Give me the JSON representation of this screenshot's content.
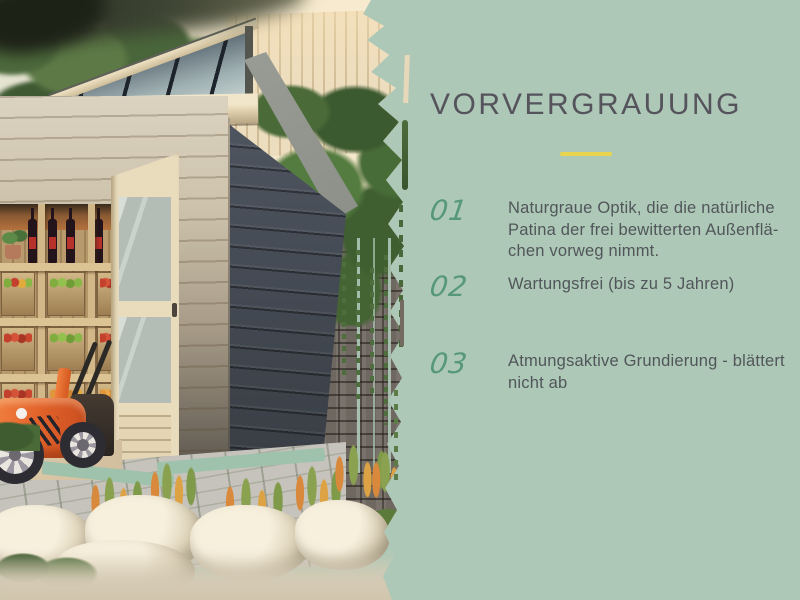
{
  "slide": {
    "background_color": "#adc8b7",
    "title": "VORVERGRAUUNG",
    "title_color": "#55535b",
    "divider_color": "#e8d54e",
    "list": {
      "number_color": "#569879",
      "text_color": "#51565a",
      "items": [
        {
          "number": "01",
          "lines": [
            "Naturgraue Optik, die die natürliche",
            "Patina der frei bewitterten Außenflä-",
            "chen vorweg nimmt."
          ]
        },
        {
          "number": "02",
          "lines": [
            "Wartungsfrei (bis zu 5 Jahren)"
          ]
        },
        {
          "number": "03",
          "lines": [
            "Atmungsaktive Grundierung - blättert",
            "nicht ab"
          ]
        }
      ]
    }
  },
  "photo": {
    "alt": "Garden shed with pre-greyed dark grey side wall, open glazed door, wooden shelves holding fruit crates and wine bottles, orange lawnmower, natural stone wall with ferns, rocks and ornamental grasses; torn-paper right edge over sage green background"
  }
}
